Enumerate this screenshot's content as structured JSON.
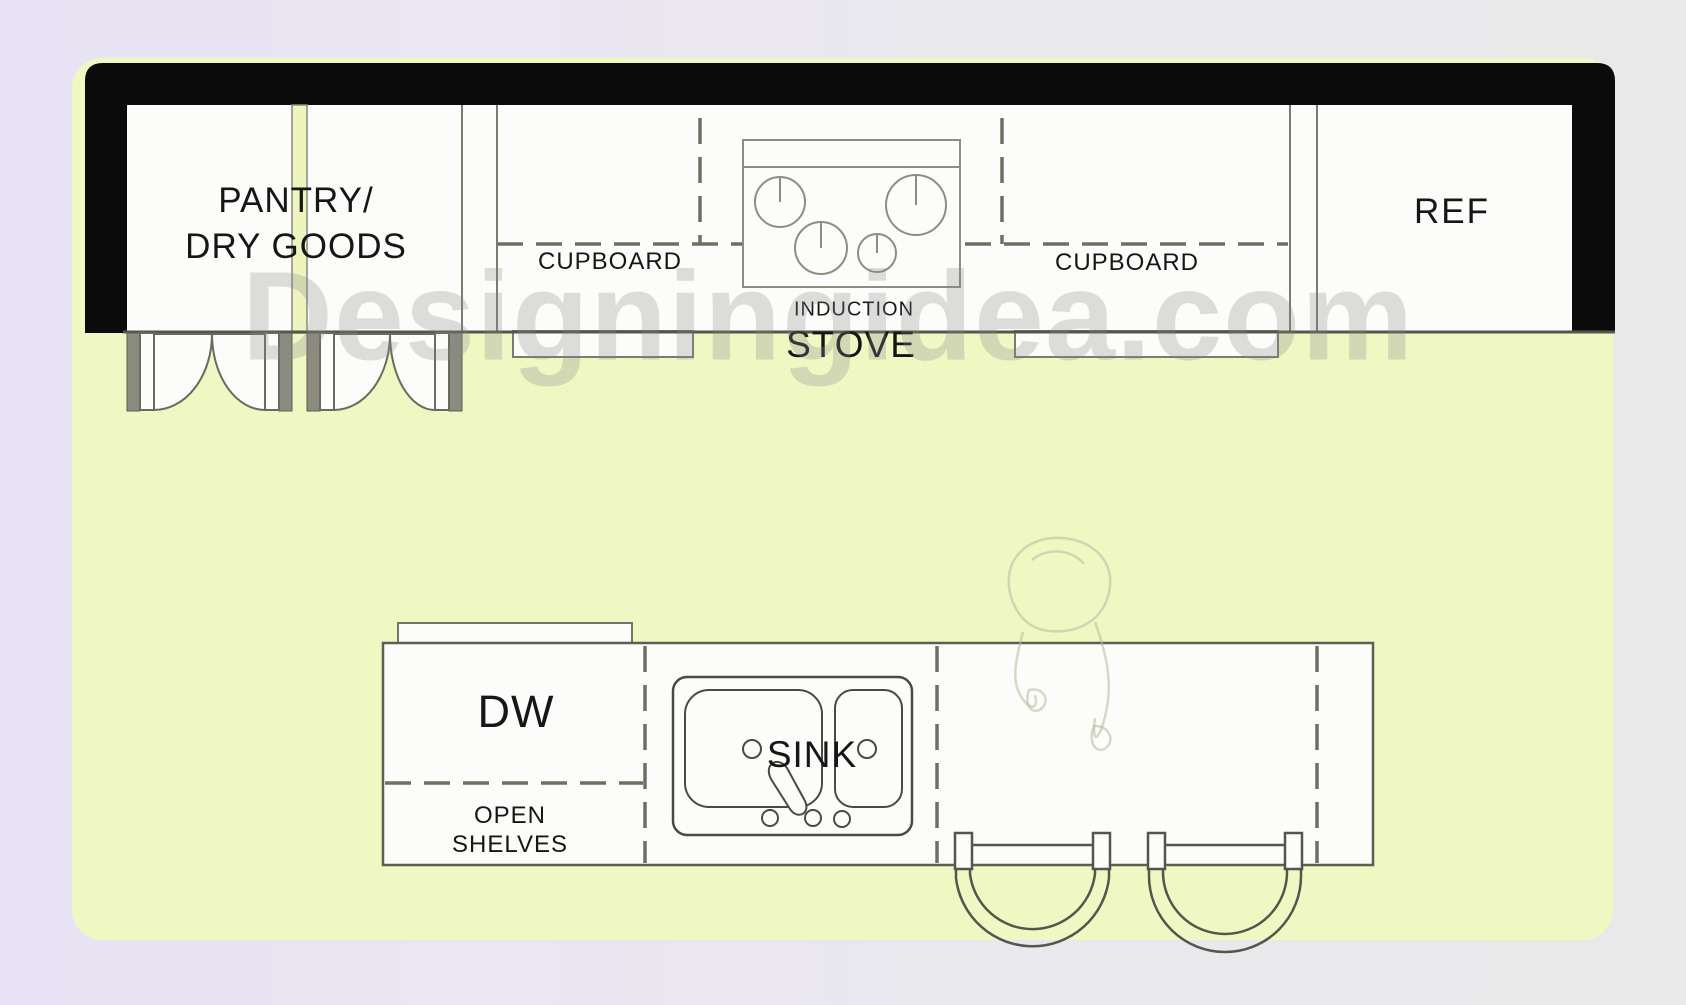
{
  "colors": {
    "background_left": "#e8e3f4",
    "background_right": "#e9e9ea",
    "floor": "#eff7c3",
    "wall": "#0b0b0b",
    "room_fill": "#fcfcfa",
    "line": "#7b7b6e",
    "dark_line": "#55554a",
    "dashed_line": "#6e6e62",
    "jamb_fill": "#8b8b7f",
    "text": "#161616",
    "watermark_color": "rgba(138,138,140,0.28)"
  },
  "watermark": {
    "text": "Designingidea.com"
  },
  "rooms": {
    "pantry": {
      "label_line1": "PANTRY/",
      "label_line2": "DRY GOODS"
    },
    "cupboard_left": {
      "label": "CUPBOARD"
    },
    "stove": {
      "label_line1": "INDUCTION",
      "label_line2": "STOVE"
    },
    "cupboard_right": {
      "label": "CUPBOARD"
    },
    "ref": {
      "label": "REF"
    },
    "island": {
      "dw": {
        "label": "DW"
      },
      "open_shelves": {
        "label_line1": "OPEN",
        "label_line2": "SHELVES"
      },
      "sink": {
        "label": "SINK"
      }
    }
  }
}
